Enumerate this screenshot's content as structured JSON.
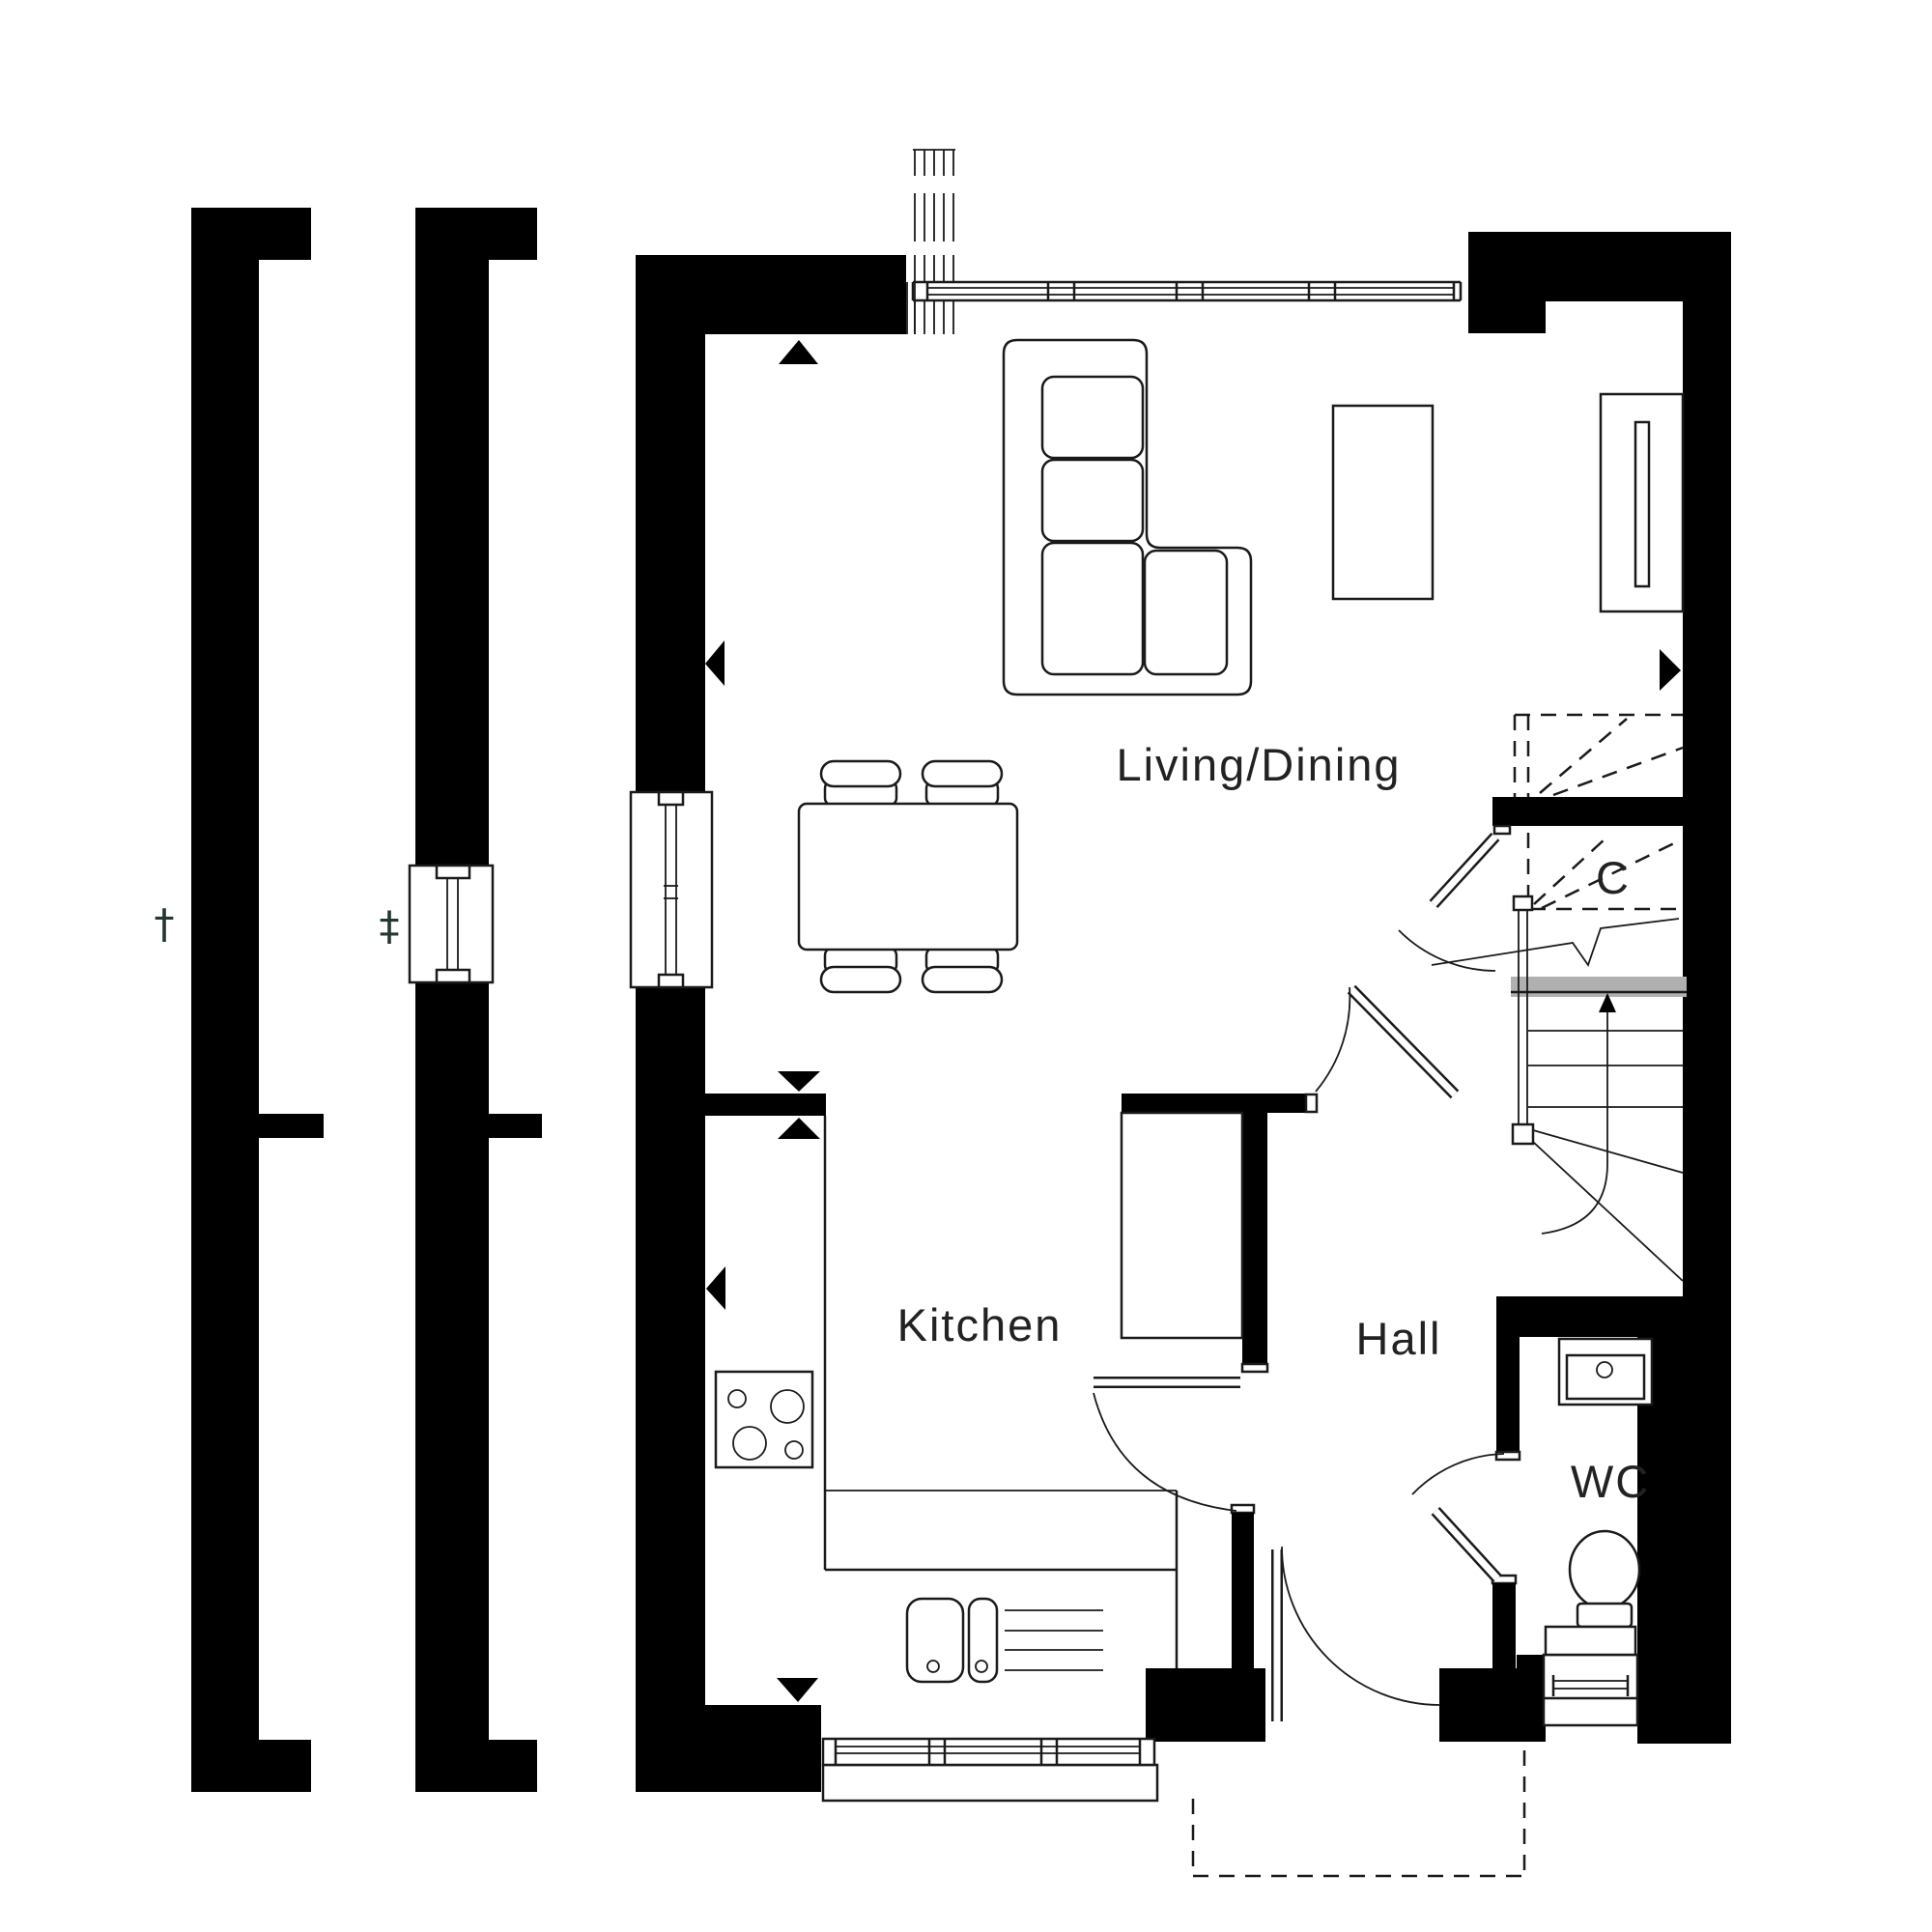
{
  "title": "Ground floor plan",
  "colors": {
    "wall": "#000000",
    "bg": "#ffffff",
    "line": "#1a1a1a",
    "grey": "#b0b0b0",
    "symbol": "#233833",
    "text": "#222222"
  },
  "labels": {
    "living_dining": "Living/Dining",
    "kitchen": "Kitchen",
    "hall": "Hall",
    "wc": "WC",
    "cupboard": "C",
    "dagger": "†",
    "double_dagger": "‡"
  }
}
